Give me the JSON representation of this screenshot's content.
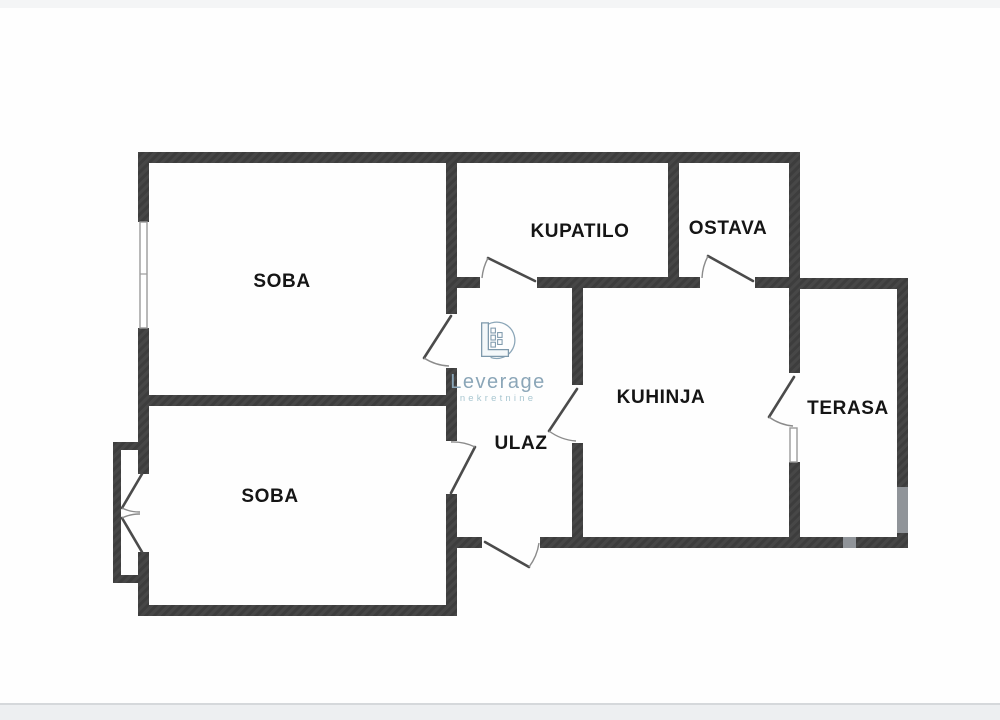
{
  "page": {
    "background": "#fefefe",
    "top_strip_color": "#f4f5f6",
    "bottom_band_color": "#edeff1",
    "bottom_edge_color": "#d5d8db"
  },
  "logo": {
    "brand": "Leverage",
    "tagline": "nekretnine",
    "brand_color": "#8ba6b8",
    "tagline_color": "#a9c7d1",
    "icon": "building-in-circle-icon"
  },
  "plan": {
    "wall_color": "#3d3d3d",
    "wall_hatch_color": "#4a4a4a",
    "wall_light_color": "#909499",
    "window_color": "#9b9b9b",
    "door_leaf_color": "#4b4b4b",
    "door_arc_color": "#8b8b8b",
    "label_color": "#151515",
    "rooms": [
      {
        "id": "soba-top",
        "label": "SOBA",
        "x": 282,
        "y": 287
      },
      {
        "id": "kupatilo",
        "label": "KUPATILO",
        "x": 580,
        "y": 237
      },
      {
        "id": "ostava",
        "label": "OSTAVA",
        "x": 728,
        "y": 234
      },
      {
        "id": "kuhinja",
        "label": "KUHINJA",
        "x": 661,
        "y": 403
      },
      {
        "id": "terasa",
        "label": "TERASA",
        "x": 848,
        "y": 414
      },
      {
        "id": "soba-bottom",
        "label": "SOBA",
        "x": 270,
        "y": 502
      },
      {
        "id": "ulaz",
        "label": "ULAZ",
        "x": 521,
        "y": 449
      }
    ],
    "walls": [
      [
        138,
        152,
        662,
        11
      ],
      [
        138,
        152,
        11,
        70
      ],
      [
        138,
        328,
        11,
        114
      ],
      [
        113,
        442,
        36,
        8
      ],
      [
        113,
        442,
        8,
        141
      ],
      [
        113,
        575,
        36,
        8
      ],
      [
        138,
        450,
        11,
        24
      ],
      [
        138,
        552,
        11,
        23
      ],
      [
        138,
        575,
        11,
        41
      ],
      [
        138,
        605,
        319,
        11
      ],
      [
        138,
        395,
        319,
        11
      ],
      [
        446,
        163,
        11,
        151
      ],
      [
        446,
        368,
        11,
        73
      ],
      [
        446,
        494,
        11,
        122
      ],
      [
        446,
        277,
        34,
        11
      ],
      [
        537,
        277,
        163,
        11
      ],
      [
        755,
        277,
        45,
        11
      ],
      [
        668,
        163,
        11,
        114
      ],
      [
        789,
        152,
        11,
        136
      ],
      [
        789,
        278,
        119,
        11
      ],
      [
        572,
        288,
        11,
        97
      ],
      [
        572,
        443,
        11,
        105
      ],
      [
        446,
        537,
        36,
        11
      ],
      [
        540,
        537,
        43,
        11
      ],
      [
        583,
        537,
        260,
        11
      ],
      [
        856,
        537,
        52,
        11
      ],
      [
        789,
        288,
        11,
        85
      ],
      [
        789,
        462,
        11,
        86
      ],
      [
        897,
        278,
        11,
        209
      ],
      [
        897,
        533,
        11,
        15
      ]
    ],
    "light_walls": [
      [
        897,
        487,
        11,
        46
      ],
      [
        843,
        537,
        13,
        11
      ]
    ],
    "windows": [
      {
        "id": "soba-top-window",
        "x": 140,
        "y": 222,
        "w": 7,
        "h": 106,
        "tick_at": 274
      },
      {
        "id": "terasa-side-window",
        "x": 790,
        "y": 428,
        "w": 7,
        "h": 34
      }
    ],
    "doors": [
      {
        "id": "kupatilo-door",
        "hinge": [
          535,
          281
        ],
        "tip": [
          488,
          258
        ],
        "jamb": [
          482,
          278
        ]
      },
      {
        "id": "ostava-door",
        "hinge": [
          753,
          281
        ],
        "tip": [
          708,
          256
        ],
        "jamb": [
          702,
          278
        ]
      },
      {
        "id": "soba-top-door",
        "hinge": [
          451,
          316
        ],
        "tip": [
          424,
          358
        ],
        "jamb": [
          449,
          366
        ]
      },
      {
        "id": "soba-bottom-door",
        "hinge": [
          451,
          493
        ],
        "tip": [
          475,
          447
        ],
        "jamb": [
          451,
          442
        ]
      },
      {
        "id": "kuhinja-door",
        "hinge": [
          577,
          389
        ],
        "tip": [
          549,
          431
        ],
        "jamb": [
          576,
          441
        ]
      },
      {
        "id": "entrance-door",
        "hinge": [
          485,
          542
        ],
        "tip": [
          529,
          567
        ],
        "jamb": [
          539,
          543
        ]
      },
      {
        "id": "terasa-door",
        "hinge": [
          794,
          377
        ],
        "tip": [
          769,
          417
        ],
        "jamb": [
          793,
          426
        ]
      },
      {
        "id": "bay-door-upper",
        "hinge": [
          142,
          474
        ],
        "tip": [
          122,
          508
        ],
        "jamb": [
          140,
          512
        ]
      },
      {
        "id": "bay-door-lower",
        "hinge": [
          142,
          552
        ],
        "tip": [
          122,
          518
        ],
        "jamb": [
          140,
          514
        ]
      }
    ]
  }
}
